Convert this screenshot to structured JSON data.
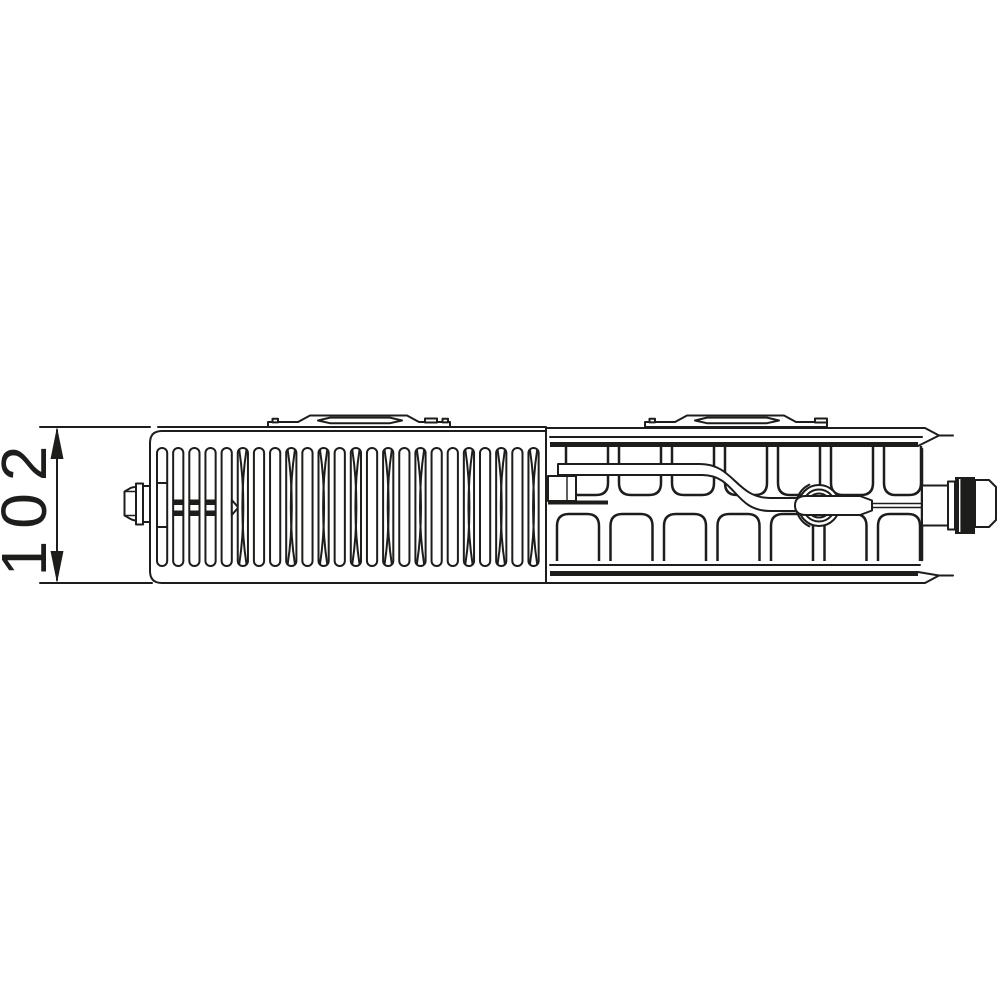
{
  "meta": {
    "background_color": "#ffffff",
    "line_color": "#1d1d1b",
    "drawing_type": "radiator-profile-technical-drawing"
  },
  "dimension": {
    "label": "102",
    "orientation": "vertical",
    "arrow_color": "#1d1d1b"
  },
  "front_grille": {
    "fin_count": 24,
    "x0": 157,
    "pitch": 16.15,
    "width": 10.2,
    "top": 448,
    "bottom": 566,
    "rx": 5,
    "hourglass_indices": [
      5,
      8,
      10,
      12,
      14,
      16,
      19,
      21,
      23
    ],
    "midbar_indices": [
      1,
      2,
      3
    ],
    "divider_index": 0,
    "notch_index": 4
  },
  "convector_section": {
    "upper_teeth": {
      "count": 7,
      "x0": 566,
      "pitch": 53,
      "width": 42,
      "top": 446,
      "bottom": 495,
      "r": 12,
      "clamp_right": 921
    },
    "lower_teeth": {
      "count": 7,
      "x0": 557,
      "pitch": 53.5,
      "width": 42,
      "top": 514,
      "bottom": 561,
      "r": 12,
      "clamp_right": 921
    }
  }
}
